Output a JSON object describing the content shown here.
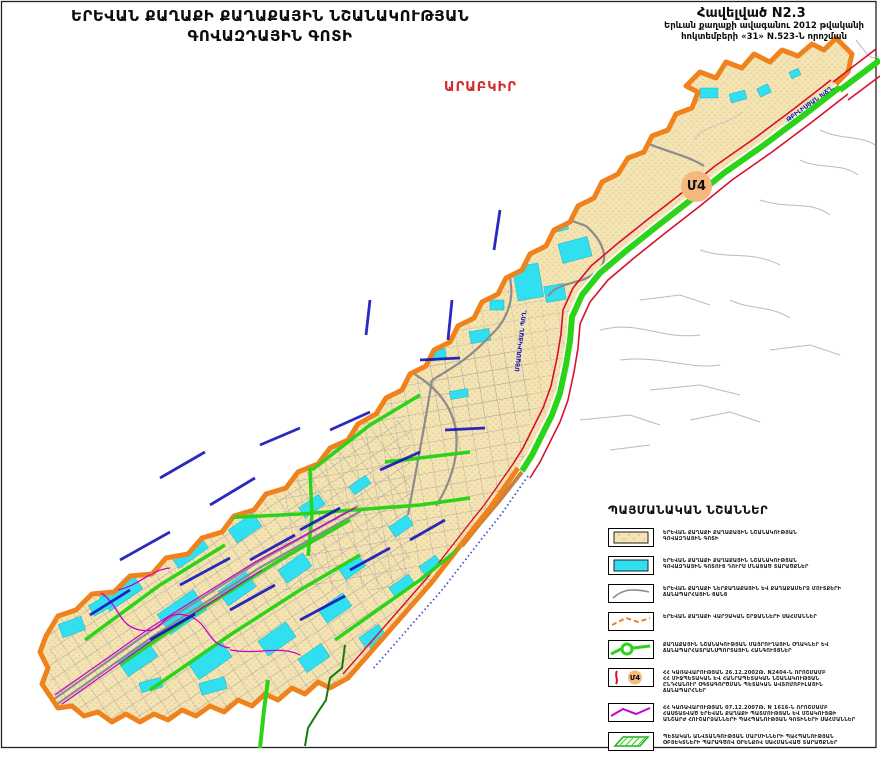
{
  "header": {
    "title_line1": "ԵՐԵՎԱՆ ՔԱՂԱՔԻ ՔԱՂԱՔԱՅԻՆ ՆՇԱՆԱԿՈՒԹՅԱՆ",
    "title_line2": "ԳՈՎԱԶԴԱՅԻՆ ԳՈՏԻ",
    "appendix_title": "Հավելված N2.3",
    "appendix_line1": "Երևան քաղաքի ավագանու 2012 թվականի",
    "appendix_line2": "հոկտեմբերի «31» N.523-Ն  որոշման"
  },
  "map": {
    "district_label": "ԱՐԱԲԿԻՐ",
    "road_badge": "Մ4",
    "street_labels": [
      {
        "text": "ՄՅԱՍՆԻԿՅԱՆ ՊՈՂ.",
        "x": 519,
        "y": 372,
        "rotate": -83
      },
      {
        "text": "ԹԲԻԼԻՍՅԱՆ ԽՃՂ.",
        "x": 788,
        "y": 122,
        "rotate": -36
      }
    ],
    "colors": {
      "advert_zone_fill": "#F4E4B4",
      "outside_zone_fill": "#30E0F0",
      "district_boundary": "#F0821E",
      "city_highway_green": "#2BD319",
      "state_road_red": "#D8102C",
      "monument_zone_magenta": "#CC00CC",
      "road_network_gray": "#8C8C8C",
      "street_label_blue": "#1414B8",
      "badge_fill": "#F5B87E",
      "district_label_red": "#D42A2A"
    }
  },
  "legend": {
    "title": "ՊԱՅՄԱՆԱԿԱՆ ՆՇԱՆՆԵՐ",
    "items": [
      {
        "swatch": "beige-area",
        "lines": [
          "ԵՐԵՎԱՆ ՔԱՂԱՔԻ ՔԱՂԱՔԱՅԻՆ ՆՇԱՆԱԿՈՒԹՅԱՆ",
          "ԳՈՎԱԶԴԱՅԻՆ ԳՈՏԻ"
        ]
      },
      {
        "swatch": "cyan-area",
        "lines": [
          "ԵՐԵՎԱՆ ՔԱՂԱՔԻ ՔԱՂԱՔԱՅԻՆ ՆՇԱՆԱԿՈՒԹՅԱՆ",
          "ԳՈՎԱԶԴԱՅԻՆ ԳՈՏՈՒՑ ԴՈՒՐՍ ՄՆԱՑԱԾ ՏԱՐԱԾՔՆԵՐ"
        ]
      },
      {
        "swatch": "gray-line",
        "lines": [
          "ԵՐԵՎԱՆ ՔԱՂԱՔԻ ՆԵՐՔԱՂԱՔԱՅԻՆ ԵՎ ՔԱՂԱՔԱՄԵՐՁ ՄՈՒՏՔԵՐԻ",
          "ՃԱՆԱՊԱՐՀԱՅԻՆ ՑԱՆՑ"
        ]
      },
      {
        "swatch": "orange-dashed",
        "lines": [
          "ԵՐԵՎԱՆ ՔԱՂԱՔԻ ՎԱՐՉԱԿԱՆ ՇՐՋԱՆՆԵՐԻ ՍԱՀՄԱՆՆԵՐ"
        ]
      },
      {
        "swatch": "green-loop",
        "lines": [
          "ՔԱՂԱՔԱՅԻՆ ՆՇԱՆԱԿՈՒԹՅԱՆ ՄԱՅՐՈՒՂԱՅԻՆ ՕՂԱԿՆԵՐ ԵՎ",
          "ՃԱՆԱՊԱՐՀԱՏՐԱՆՍՊՈՐՏԱՅԻՆ ՀԱՆԳՈՒՅՑՆԵՐ"
        ]
      },
      {
        "swatch": "m4-road",
        "lines": [
          "ՀՀ ԿԱՌԱՎԱՐՈՒԹՅԱՆ 26.12.2002Թ. N2404-Ն ՈՐՈՇՄԱՄԲ",
          "ՀՀ ՄԻՋՊԵՏԱԿԱՆ ԵՎ ՀԱՆՐԱՊԵՏԱԿԱՆ ՆՇԱՆԱԿՈՒԹՅԱՆ",
          "ԸՆԴՀԱՆՈՒՐ ՕԳՏԱԳՈՐԾՄԱՆ ՊԵՏԱԿԱՆ ԱՎՏՈՄՈԲԻԼԱՅԻՆ",
          "ՃԱՆԱՊԱՐՀՆԵՐ"
        ]
      },
      {
        "swatch": "magenta-line",
        "lines": [
          "ՀՀ ԿԱՌԱՎԱՐՈՒԹՅԱՆ 07.12.2007Թ. N 1616-Ն ՈՐՈՇՄԱՄԲ",
          "ՀԱՍՏԱՏՎԱԾ ԵՐԵՎԱՆ ՔԱՂԱՔԻ ՊԱՏՄՈՒԹՅԱՆ ԵՎ ՄՇԱԿՈՒՅԹԻ",
          "ԱՆՇԱՐԺ ՀՈՒՇԱՐՁԱՆՆԵՐԻ ՊԱՀՊԱՆՈՒԹՅԱՆ ԳՈՏԻՆԵՐԻ ՍԱՀՄԱՆՆԵՐ"
        ]
      },
      {
        "swatch": "green-hatched",
        "lines": [
          "ՊԵՏԱԿԱՆ ԱՆՎՏԱՆԳՈՒԹՅԱՆ ՄԱՐՄԻՆՆԵՐԻ ՊԱՀՊԱՆՈՒԹՅԱՆ",
          "ՕԲՅԵԿՏՆԵՐԻ ՊԱՐԱԳԾՈՎ ՕՐԵՆՔՈՎ ՍԱՀՄԱՆՎԱԾ ՏԱՐԱԾՔՆԵՐ"
        ]
      }
    ]
  }
}
